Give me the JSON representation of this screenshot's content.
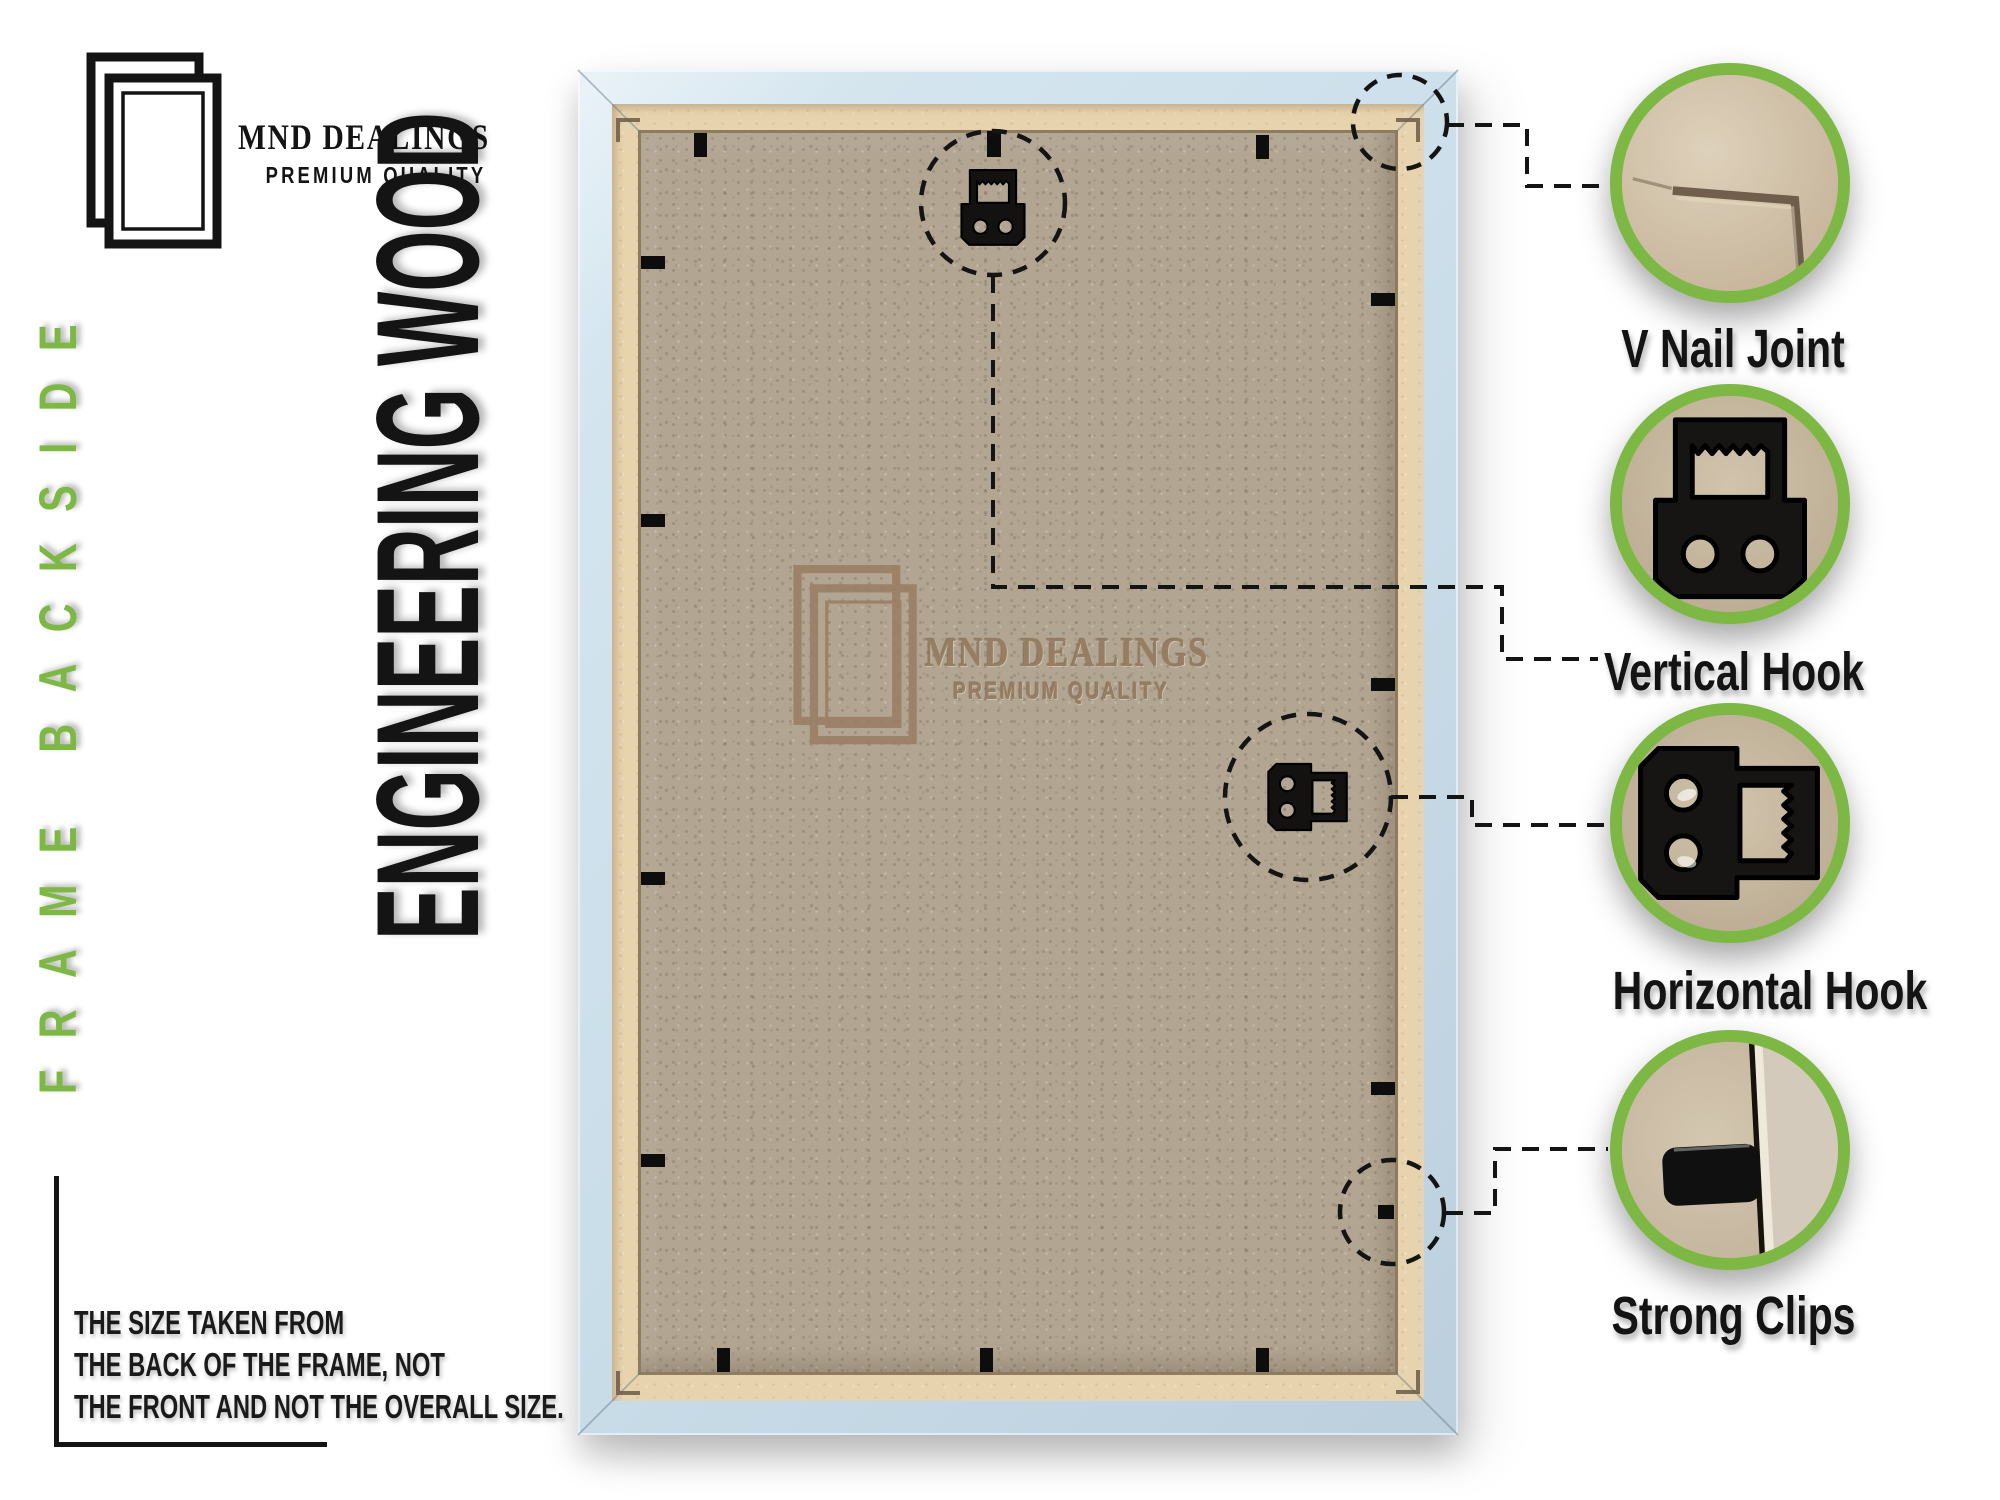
{
  "brand": {
    "name": "MND DEALINGS",
    "tagline": "PREMIUM QUALITY"
  },
  "side_label": "FRAME BACKSIDE",
  "material_label": "ENGINEERING WOOD",
  "watermark": {
    "name": "MND DEALINGS",
    "tagline": "PREMIUM QUALITY"
  },
  "note": {
    "lines": [
      "THE SIZE TAKEN FROM",
      "THE BACK OF THE FRAME, NOT",
      "THE FRONT AND NOT THE OVERALL SIZE."
    ]
  },
  "callouts": [
    {
      "id": "v-nail-joint",
      "label": "V Nail Joint"
    },
    {
      "id": "vertical-hook",
      "label": "Vertical Hook"
    },
    {
      "id": "horizontal-hook",
      "label": "Horizontal Hook"
    },
    {
      "id": "strong-clips",
      "label": "Strong Clips"
    }
  ],
  "colors": {
    "accent_green": "#7cb843",
    "frame_blue": "#cadde9",
    "frame_border_tan": "#e7d3ad",
    "backboard": "#b2a592",
    "ink": "#141414",
    "emboss": "#977d61"
  }
}
